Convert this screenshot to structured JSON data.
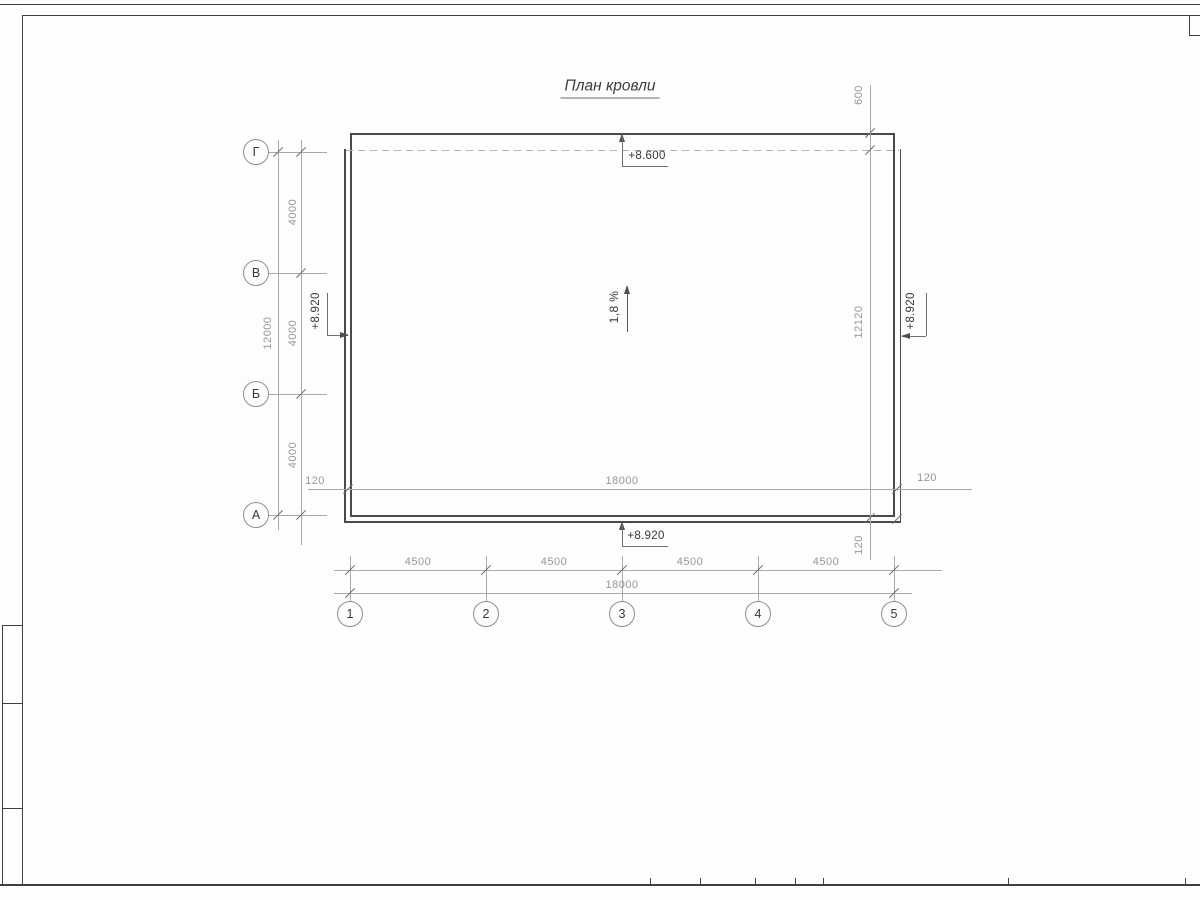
{
  "colors": {
    "line_dark": "#4a4a4a",
    "line_frame": "#3f3f3f",
    "line_dim": "#a8a8a8",
    "text_dim": "#969696",
    "text_dark": "#383838",
    "paper": "#fdfdfd"
  },
  "drawing": {
    "title": "План кровли",
    "slope": "1,8 %",
    "elev_top": "+8.600",
    "elev_bottom": "+8.920",
    "elev_left": "+8.920",
    "elev_right": "+8.920"
  },
  "axes": {
    "rows": [
      "Г",
      "В",
      "Б",
      "А"
    ],
    "cols": [
      "1",
      "2",
      "3",
      "4",
      "5"
    ]
  },
  "dims": {
    "left_spans": [
      "4000",
      "4000",
      "4000"
    ],
    "left_total": "12000",
    "bottom_spans": [
      "4500",
      "4500",
      "4500",
      "4500"
    ],
    "bottom_total": "18000",
    "inner_width": "18000",
    "overhang_left": "120",
    "overhang_right": "120",
    "overhang_bottom": "120",
    "overhang_top": "600",
    "right_height": "12120"
  }
}
